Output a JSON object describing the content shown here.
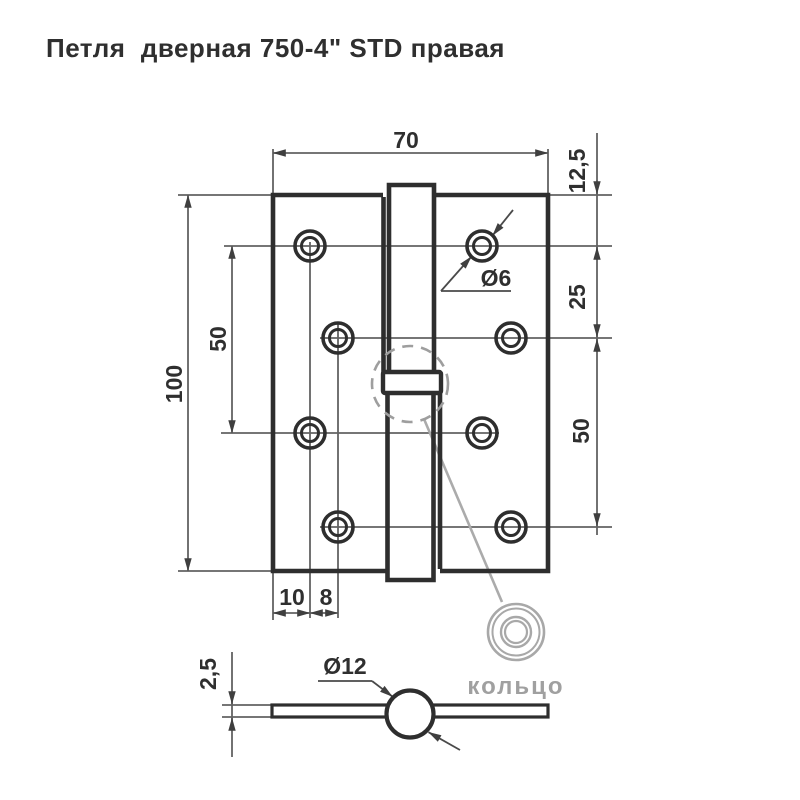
{
  "title": "Петля  дверная 750-4\" STD правая",
  "main_view": {
    "dim_width": "70",
    "dim_height": "100",
    "dim_left_hole_span": "50",
    "dim_top_offset": "12,5",
    "dim_row_pitch": "25",
    "dim_right_hole_span": "50",
    "dim_edge_margin": "10",
    "dim_hole_inset": "8",
    "dim_hole_diameter": "Ø6"
  },
  "bottom_view": {
    "dim_thickness": "2,5",
    "dim_barrel_diameter": "Ø12"
  },
  "detail": {
    "ring_label": "кольцо"
  },
  "colors": {
    "outline": "#2e2e2e",
    "thin_line": "#636363",
    "arrow": "#3f3f3f",
    "detail_gray": "#a8a8a8",
    "background": "#ffffff"
  }
}
